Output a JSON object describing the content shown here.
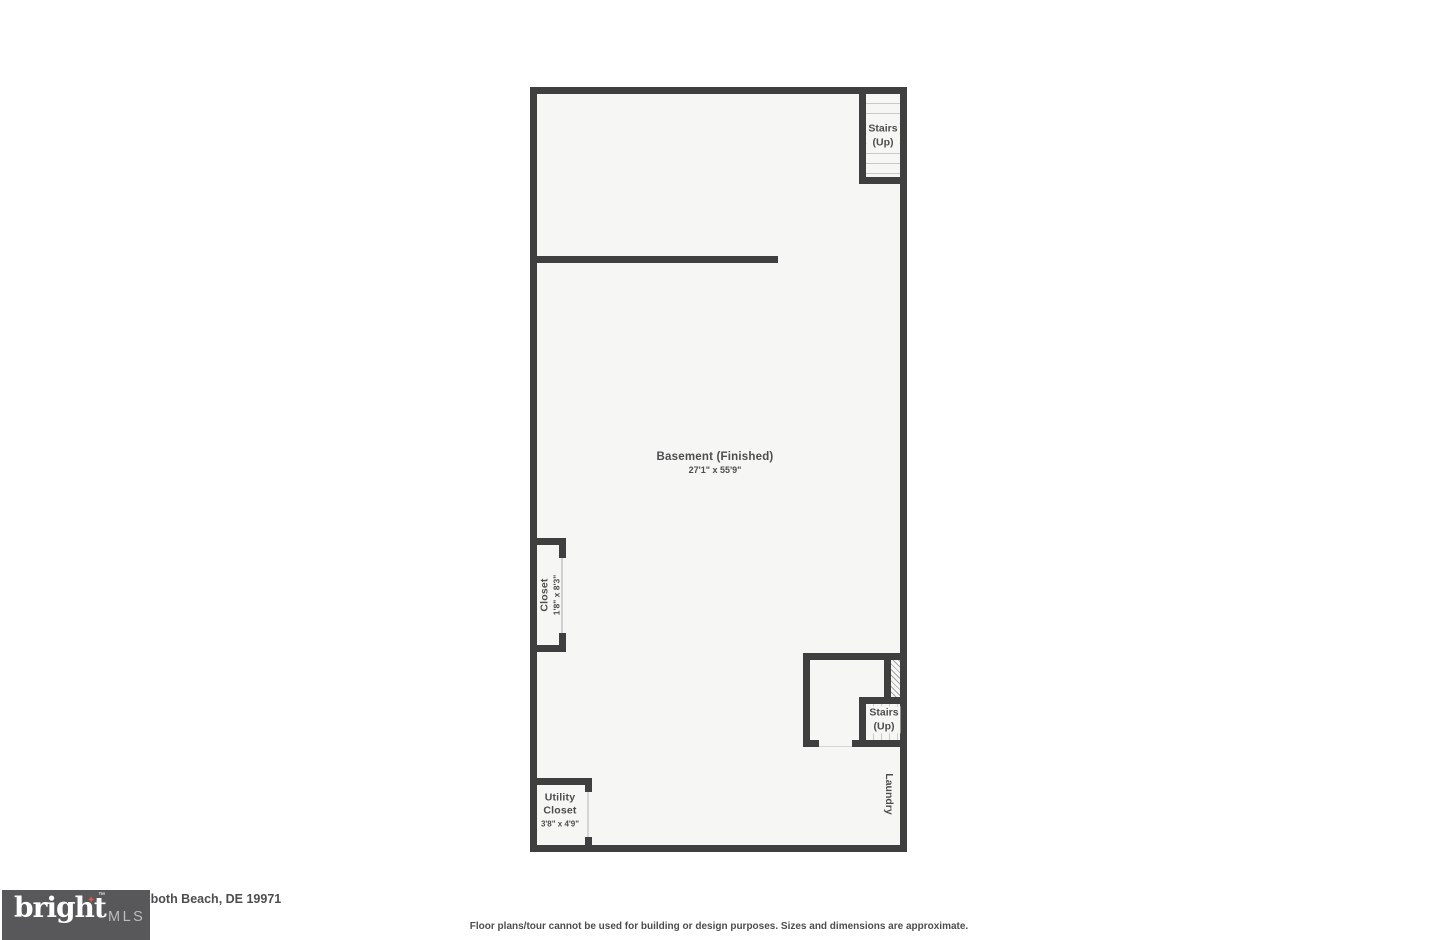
{
  "colors": {
    "wall": "#3f3f3f",
    "floor": "#f6f6f5",
    "tread_line": "#c9c9c9",
    "hatch_line": "#a5a5a5",
    "label_text": "#4d4d4d",
    "logo_background": "#58585a",
    "logo_brand_text": "#ffffff",
    "logo_star": "#e8543f",
    "logo_mls_text": "#bcbcbe"
  },
  "floor_plan": {
    "basement": {
      "label": "Basement (Finished)",
      "dimensions": "27'1\" x 55'9\""
    },
    "stairs_top": {
      "line1": "Stairs",
      "line2": "(Up)"
    },
    "stairs_bottom": {
      "line1": "Stairs",
      "line2": "(Up)"
    },
    "closet": {
      "label": "Closet",
      "dimensions": "1'8\" x 8'3\""
    },
    "utility_closet": {
      "line1": "Utility",
      "line2": "Closet",
      "dimensions": "3'8\" x 4'9\""
    },
    "laundry": {
      "label": "Laundry"
    }
  },
  "logo": {
    "brand": "bright",
    "trademark": "™",
    "suffix": "MLS",
    "star_glyph": "✦"
  },
  "footer": {
    "address": "oboth Beach, DE 19971",
    "disclaimer": "Floor plans/tour cannot be used for building or design purposes. Sizes and dimensions are approximate."
  }
}
